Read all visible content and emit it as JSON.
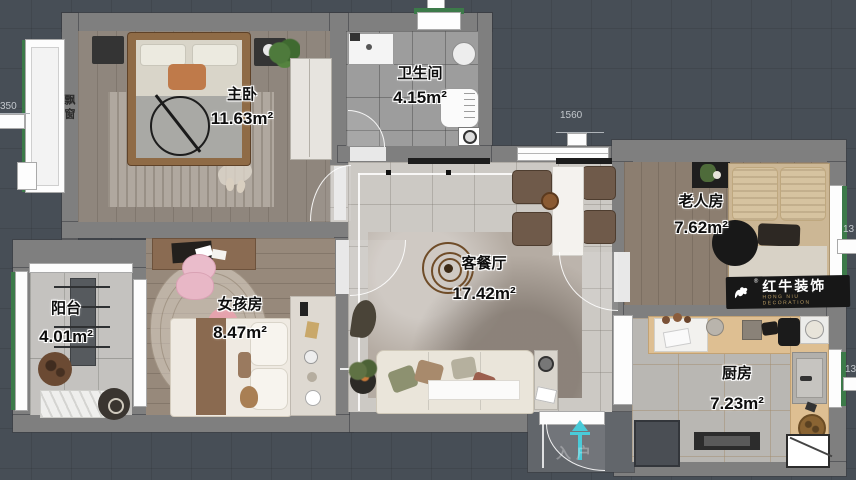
{
  "rooms": {
    "master": {
      "name": "主卧",
      "area": "11.63m²"
    },
    "bathroom": {
      "name": "卫生间",
      "area": "4.15m²"
    },
    "elderly": {
      "name": "老人房",
      "area": "7.62m²"
    },
    "living": {
      "name": "客餐厅",
      "area": "17.42m²"
    },
    "girl": {
      "name": "女孩房",
      "area": "8.47m²"
    },
    "balcony": {
      "name": "阳台",
      "area": "4.01m²"
    },
    "kitchen": {
      "name": "厨房",
      "area": "7.23m²"
    }
  },
  "labels": {
    "bay_window": "飘窗",
    "entrance": "入户"
  },
  "dims": {
    "top_window": "1560",
    "left_partial": "350",
    "right_upper_partial": "13",
    "right_lower_partial": "131"
  },
  "watermark": {
    "brand": "红牛装饰",
    "sub": "HONG NIU DECORATION",
    "registered": "®"
  },
  "colors": {
    "background": "#474e56",
    "wall": "#7f7f7f",
    "entrance_arrow": "#49cbd9",
    "watermark_bg": "#171717",
    "watermark_gold": "#b89b63"
  }
}
